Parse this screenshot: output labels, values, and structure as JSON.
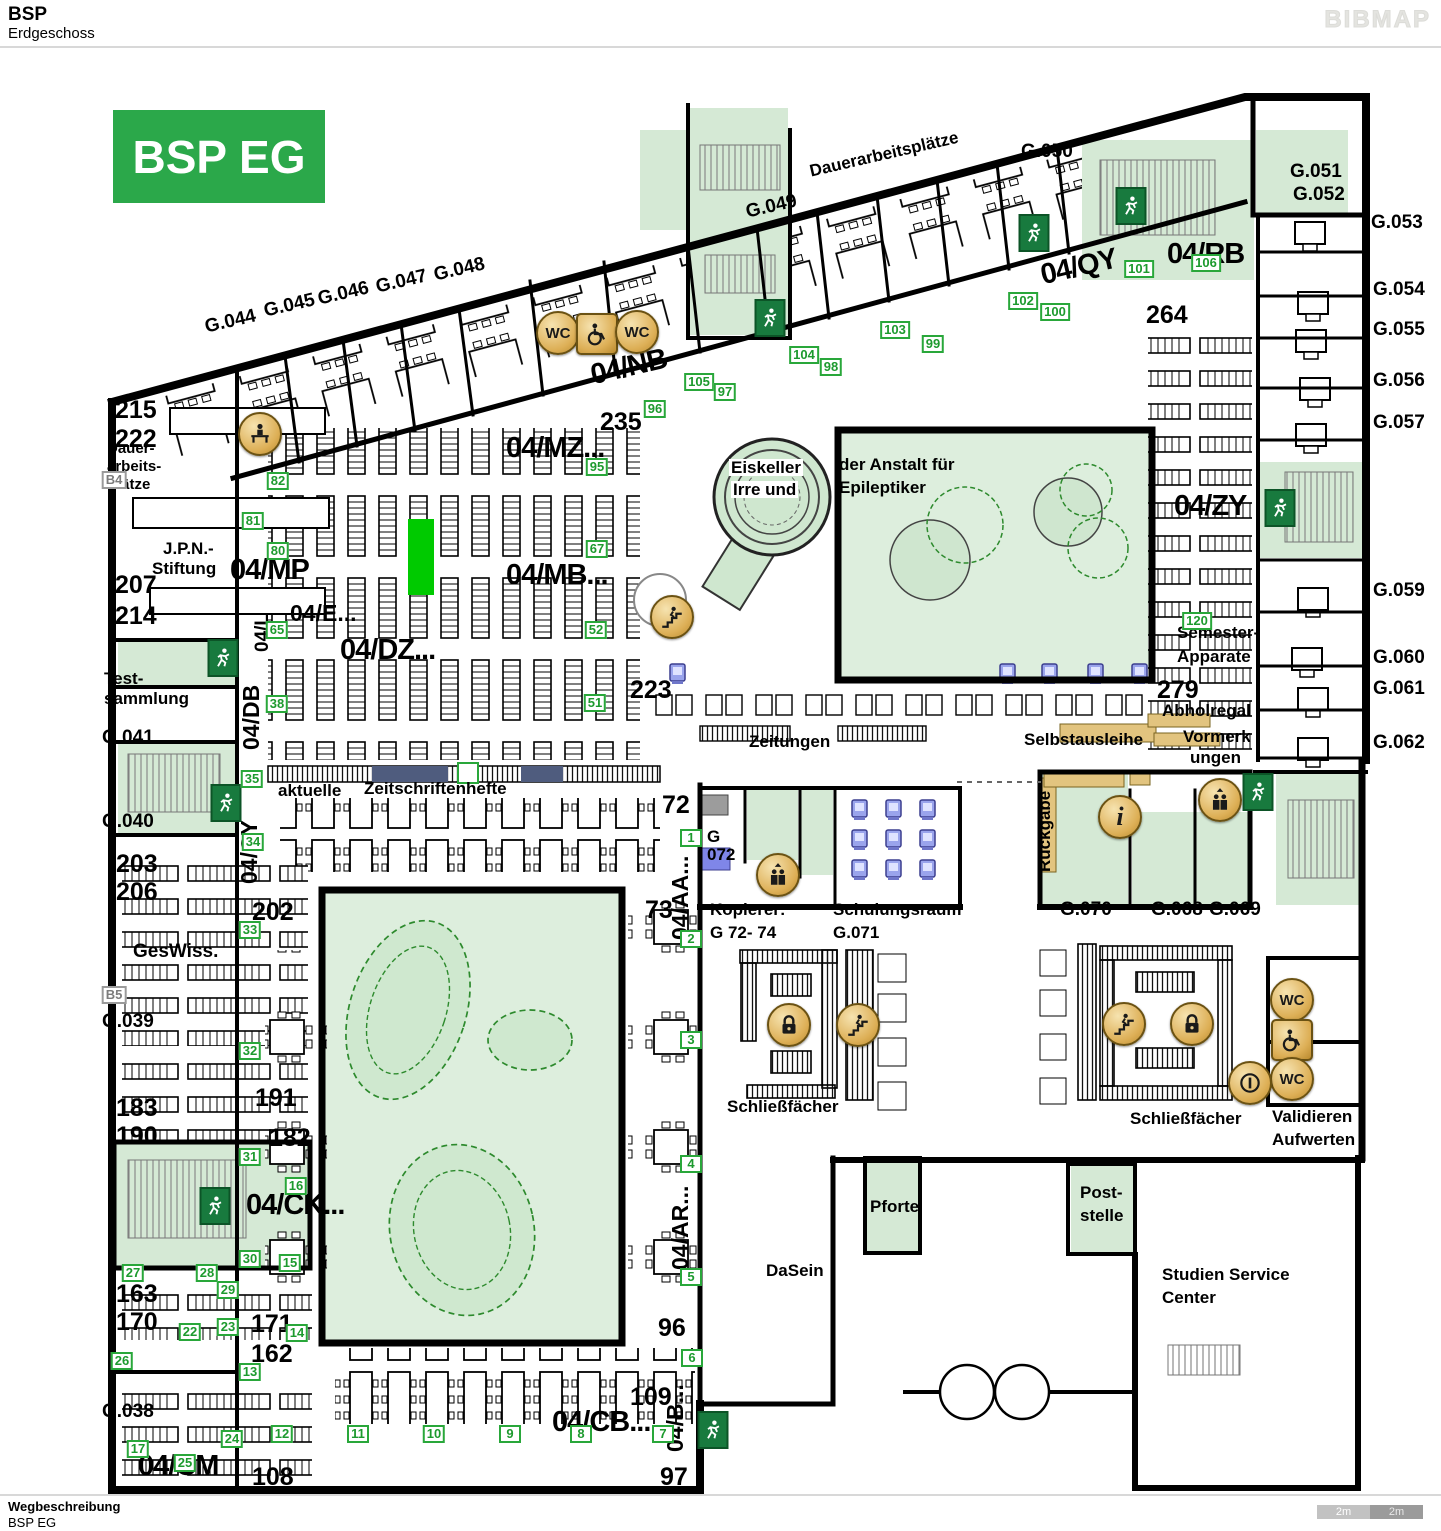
{
  "header": {
    "title": "BSP",
    "subtitle": "Erdgeschoss",
    "logo": "BIBMAP"
  },
  "footer": {
    "label": "Wegbeschreibung",
    "value": "BSP EG",
    "scale": [
      "2m",
      "2m"
    ]
  },
  "plan": {
    "badge": "BSP EG",
    "colors": {
      "badge_green": "#2ba84a",
      "room_green": "#d5e9d5",
      "courtyard_green": "#ddeedd",
      "tree_green": "#2d8a2d",
      "marker_green": "#29a73a",
      "icon_tan": "#ddaf56",
      "exit_green": "#187a3e",
      "khaki": "#e2c47f",
      "navy": "#4f5c7e",
      "computer_blue": "#9aa4ec",
      "highlight_green": "#00ca00",
      "wall_black": "#000000"
    },
    "labels": [
      {
        "t": "G.044",
        "x": 203,
        "y": 318,
        "c": "room",
        "r": -13
      },
      {
        "t": "G.045",
        "x": 262,
        "y": 302,
        "c": "room",
        "r": -13
      },
      {
        "t": "G.046",
        "x": 316,
        "y": 290,
        "c": "room",
        "r": -13
      },
      {
        "t": "G.047",
        "x": 374,
        "y": 278,
        "c": "room",
        "r": -13
      },
      {
        "t": "G.048",
        "x": 432,
        "y": 266,
        "c": "room",
        "r": -13
      },
      {
        "t": "G.049",
        "x": 744,
        "y": 203,
        "c": "room",
        "r": -13
      },
      {
        "t": "Dauerarbeitsplätze",
        "x": 808,
        "y": 163,
        "c": "sm",
        "r": -13
      },
      {
        "t": "G.050",
        "x": 1021,
        "y": 142,
        "c": "room"
      },
      {
        "t": "G.051",
        "x": 1290,
        "y": 162,
        "c": "room"
      },
      {
        "t": "G.052",
        "x": 1293,
        "y": 185,
        "c": "room"
      },
      {
        "t": "G.053",
        "x": 1371,
        "y": 213,
        "c": "room"
      },
      {
        "t": "G.054",
        "x": 1373,
        "y": 280,
        "c": "room"
      },
      {
        "t": "G.055",
        "x": 1373,
        "y": 320,
        "c": "room"
      },
      {
        "t": "G.056",
        "x": 1373,
        "y": 371,
        "c": "room"
      },
      {
        "t": "G.057",
        "x": 1373,
        "y": 413,
        "c": "room"
      },
      {
        "t": "G.059",
        "x": 1373,
        "y": 581,
        "c": "room"
      },
      {
        "t": "G.060",
        "x": 1373,
        "y": 648,
        "c": "room"
      },
      {
        "t": "G.061",
        "x": 1373,
        "y": 679,
        "c": "room"
      },
      {
        "t": "G.062",
        "x": 1373,
        "y": 733,
        "c": "room"
      },
      {
        "t": "04/QY",
        "x": 1038,
        "y": 262,
        "c": "xl",
        "r": -13
      },
      {
        "t": "04/RB",
        "x": 1167,
        "y": 240,
        "c": "xl"
      },
      {
        "t": "264",
        "x": 1146,
        "y": 303,
        "c": "num"
      },
      {
        "t": "04/NB",
        "x": 588,
        "y": 362,
        "c": "xl",
        "r": -13
      },
      {
        "t": "235",
        "x": 600,
        "y": 410,
        "c": "num"
      },
      {
        "t": "04/MZ...",
        "x": 506,
        "y": 434,
        "c": "xl"
      },
      {
        "t": "215",
        "x": 115,
        "y": 398,
        "c": "num"
      },
      {
        "t": "222",
        "x": 115,
        "y": 427,
        "c": "num"
      },
      {
        "t": "Dauer-",
        "x": 107,
        "y": 441,
        "c": "sm2"
      },
      {
        "t": "arbeits-",
        "x": 107,
        "y": 459,
        "c": "sm2"
      },
      {
        "t": "Plätze",
        "x": 107,
        "y": 477,
        "c": "sm2"
      },
      {
        "t": "J.P.N.-",
        "x": 163,
        "y": 540,
        "c": "sm"
      },
      {
        "t": "Stiftung",
        "x": 152,
        "y": 560,
        "c": "sm"
      },
      {
        "t": "207",
        "x": 115,
        "y": 573,
        "c": "num"
      },
      {
        "t": "214",
        "x": 115,
        "y": 604,
        "c": "num"
      },
      {
        "t": "04/MP",
        "x": 230,
        "y": 556,
        "c": "xl"
      },
      {
        "t": "04/MB...",
        "x": 506,
        "y": 561,
        "c": "xl"
      },
      {
        "t": "04/E...",
        "x": 290,
        "y": 602,
        "c": "lg"
      },
      {
        "t": "04/DZ...",
        "x": 340,
        "y": 636,
        "c": "xl"
      },
      {
        "t": "04/L",
        "x": 253,
        "y": 652,
        "c": "room",
        "r": -90
      },
      {
        "t": "04/DB",
        "x": 240,
        "y": 750,
        "c": "lg",
        "r": -90
      },
      {
        "t": "Test-",
        "x": 104,
        "y": 670,
        "c": "sm"
      },
      {
        "t": "sammlung",
        "x": 104,
        "y": 690,
        "c": "sm"
      },
      {
        "t": "G.041",
        "x": 102,
        "y": 728,
        "c": "room"
      },
      {
        "t": "G.040",
        "x": 102,
        "y": 812,
        "c": "room"
      },
      {
        "t": "04/CY",
        "x": 238,
        "y": 884,
        "c": "lg",
        "r": -90
      },
      {
        "t": "203",
        "x": 116,
        "y": 852,
        "c": "num"
      },
      {
        "t": "206",
        "x": 116,
        "y": 880,
        "c": "num"
      },
      {
        "t": "GesWiss.",
        "x": 133,
        "y": 942,
        "c": "room"
      },
      {
        "t": "202",
        "x": 252,
        "y": 900,
        "c": "num"
      },
      {
        "t": "G.039",
        "x": 102,
        "y": 1012,
        "c": "room"
      },
      {
        "t": "aktuelle",
        "x": 278,
        "y": 782,
        "c": "sm"
      },
      {
        "t": "Zeitschriftenhefte",
        "x": 364,
        "y": 780,
        "c": "sm"
      },
      {
        "t": "72",
        "x": 662,
        "y": 793,
        "c": "num"
      },
      {
        "t": "73",
        "x": 645,
        "y": 898,
        "c": "num"
      },
      {
        "t": "G",
        "x": 707,
        "y": 828,
        "c": "sm"
      },
      {
        "t": "072",
        "x": 707,
        "y": 846,
        "c": "sm"
      },
      {
        "t": "Kopierer:",
        "x": 710,
        "y": 901,
        "c": "sm"
      },
      {
        "t": "G 72- 74",
        "x": 710,
        "y": 924,
        "c": "sm"
      },
      {
        "t": "Schulungsraum",
        "x": 833,
        "y": 901,
        "c": "sm"
      },
      {
        "t": "G.071",
        "x": 833,
        "y": 924,
        "c": "sm"
      },
      {
        "t": "Rückgabe",
        "x": 1036,
        "y": 872,
        "c": "sm",
        "r": -90
      },
      {
        "t": "G.070",
        "x": 1060,
        "y": 900,
        "c": "room"
      },
      {
        "t": "G.068",
        "x": 1151,
        "y": 900,
        "c": "room"
      },
      {
        "t": "G.069",
        "x": 1209,
        "y": 900,
        "c": "room"
      },
      {
        "t": "223",
        "x": 630,
        "y": 678,
        "c": "num"
      },
      {
        "t": "Zeitungen",
        "x": 749,
        "y": 733,
        "c": "sm"
      },
      {
        "t": "Selbstausleihe",
        "x": 1024,
        "y": 731,
        "c": "sm"
      },
      {
        "t": "279",
        "x": 1157,
        "y": 678,
        "c": "num"
      },
      {
        "t": "Abholregal",
        "x": 1162,
        "y": 702,
        "c": "sm"
      },
      {
        "t": "Vormerk",
        "x": 1183,
        "y": 728,
        "c": "sm"
      },
      {
        "t": "ungen",
        "x": 1190,
        "y": 749,
        "c": "sm"
      },
      {
        "t": "Semester-",
        "x": 1177,
        "y": 624,
        "c": "sm"
      },
      {
        "t": "Apparate",
        "x": 1177,
        "y": 648,
        "c": "sm"
      },
      {
        "t": "04/ZY",
        "x": 1174,
        "y": 492,
        "c": "xl"
      },
      {
        "t": "Eiskeller",
        "x": 729,
        "y": 459,
        "c": "sm",
        "bg": 1
      },
      {
        "t": "Irre und",
        "x": 731,
        "y": 481,
        "c": "sm",
        "bg": 1
      },
      {
        "t": "der Anstalt für",
        "x": 839,
        "y": 456,
        "c": "sm"
      },
      {
        "t": "Epileptiker",
        "x": 839,
        "y": 479,
        "c": "sm"
      },
      {
        "t": "04/AA...",
        "x": 669,
        "y": 940,
        "c": "lg",
        "r": -90
      },
      {
        "t": "Schließfächer",
        "x": 727,
        "y": 1098,
        "c": "sm"
      },
      {
        "t": "Schließfächer",
        "x": 1130,
        "y": 1110,
        "c": "sm"
      },
      {
        "t": "Validieren",
        "x": 1272,
        "y": 1108,
        "c": "sm"
      },
      {
        "t": "Aufwerten",
        "x": 1272,
        "y": 1131,
        "c": "sm"
      },
      {
        "t": "183",
        "x": 116,
        "y": 1096,
        "c": "num"
      },
      {
        "t": "190",
        "x": 116,
        "y": 1124,
        "c": "num"
      },
      {
        "t": "191",
        "x": 255,
        "y": 1086,
        "c": "num"
      },
      {
        "t": "182",
        "x": 269,
        "y": 1126,
        "c": "num"
      },
      {
        "t": "04/CK...",
        "x": 246,
        "y": 1191,
        "c": "xl"
      },
      {
        "t": "04/AR...",
        "x": 669,
        "y": 1270,
        "c": "lg",
        "r": -90
      },
      {
        "t": "163",
        "x": 116,
        "y": 1282,
        "c": "num"
      },
      {
        "t": "170",
        "x": 116,
        "y": 1310,
        "c": "num"
      },
      {
        "t": "171",
        "x": 251,
        "y": 1312,
        "c": "num"
      },
      {
        "t": "162",
        "x": 251,
        "y": 1342,
        "c": "num"
      },
      {
        "t": "96",
        "x": 658,
        "y": 1316,
        "c": "num"
      },
      {
        "t": "G.038",
        "x": 102,
        "y": 1402,
        "c": "room"
      },
      {
        "t": "109",
        "x": 630,
        "y": 1385,
        "c": "num"
      },
      {
        "t": "04/CB...",
        "x": 552,
        "y": 1408,
        "c": "xl"
      },
      {
        "t": "04/B...",
        "x": 664,
        "y": 1452,
        "c": "lg",
        "r": -90
      },
      {
        "t": "04/CM",
        "x": 138,
        "y": 1452,
        "c": "xl"
      },
      {
        "t": "108",
        "x": 252,
        "y": 1465,
        "c": "num"
      },
      {
        "t": "97",
        "x": 660,
        "y": 1465,
        "c": "num"
      },
      {
        "t": "Pforte",
        "x": 870,
        "y": 1198,
        "c": "sm"
      },
      {
        "t": "Post-",
        "x": 1080,
        "y": 1184,
        "c": "sm"
      },
      {
        "t": "stelle",
        "x": 1080,
        "y": 1207,
        "c": "sm"
      },
      {
        "t": "DaSein",
        "x": 766,
        "y": 1262,
        "c": "sm"
      },
      {
        "t": "Studien Service",
        "x": 1162,
        "y": 1266,
        "c": "sm"
      },
      {
        "t": "Center",
        "x": 1162,
        "y": 1289,
        "c": "sm"
      }
    ],
    "markers": [
      {
        "n": "95",
        "x": 597,
        "y": 467
      },
      {
        "n": "96",
        "x": 655,
        "y": 409
      },
      {
        "n": "105",
        "x": 699,
        "y": 382
      },
      {
        "n": "97",
        "x": 725,
        "y": 392
      },
      {
        "n": "104",
        "x": 804,
        "y": 355
      },
      {
        "n": "98",
        "x": 831,
        "y": 367
      },
      {
        "n": "103",
        "x": 895,
        "y": 330
      },
      {
        "n": "99",
        "x": 933,
        "y": 344
      },
      {
        "n": "102",
        "x": 1023,
        "y": 301
      },
      {
        "n": "100",
        "x": 1055,
        "y": 312
      },
      {
        "n": "101",
        "x": 1139,
        "y": 269
      },
      {
        "n": "106",
        "x": 1206,
        "y": 263
      },
      {
        "n": "82",
        "x": 278,
        "y": 481
      },
      {
        "n": "81",
        "x": 253,
        "y": 521
      },
      {
        "n": "80",
        "x": 278,
        "y": 551
      },
      {
        "n": "65",
        "x": 277,
        "y": 630
      },
      {
        "n": "67",
        "x": 597,
        "y": 549
      },
      {
        "n": "52",
        "x": 596,
        "y": 630
      },
      {
        "n": "51",
        "x": 595,
        "y": 703
      },
      {
        "n": "38",
        "x": 277,
        "y": 704
      },
      {
        "n": "120",
        "x": 1197,
        "y": 621
      },
      {
        "n": "35",
        "x": 252,
        "y": 779
      },
      {
        "n": "34",
        "x": 253,
        "y": 842
      },
      {
        "n": "33",
        "x": 250,
        "y": 930
      },
      {
        "n": "32",
        "x": 250,
        "y": 1051
      },
      {
        "n": "31",
        "x": 250,
        "y": 1157
      },
      {
        "n": "30",
        "x": 250,
        "y": 1259
      },
      {
        "n": "29",
        "x": 228,
        "y": 1290
      },
      {
        "n": "28",
        "x": 207,
        "y": 1273
      },
      {
        "n": "27",
        "x": 133,
        "y": 1273
      },
      {
        "n": "26",
        "x": 122,
        "y": 1361
      },
      {
        "n": "25",
        "x": 185,
        "y": 1463
      },
      {
        "n": "24",
        "x": 232,
        "y": 1439
      },
      {
        "n": "23",
        "x": 228,
        "y": 1327
      },
      {
        "n": "22",
        "x": 190,
        "y": 1332
      },
      {
        "n": "17",
        "x": 138,
        "y": 1449
      },
      {
        "n": "16",
        "x": 296,
        "y": 1186
      },
      {
        "n": "15",
        "x": 290,
        "y": 1263
      },
      {
        "n": "14",
        "x": 297,
        "y": 1333
      },
      {
        "n": "13",
        "x": 250,
        "y": 1372
      },
      {
        "n": "12",
        "x": 282,
        "y": 1434
      },
      {
        "n": "11",
        "x": 358,
        "y": 1434
      },
      {
        "n": "10",
        "x": 434,
        "y": 1434
      },
      {
        "n": "9",
        "x": 510,
        "y": 1434
      },
      {
        "n": "8",
        "x": 581,
        "y": 1434
      },
      {
        "n": "7",
        "x": 663,
        "y": 1434
      },
      {
        "n": "6",
        "x": 692,
        "y": 1358
      },
      {
        "n": "5",
        "x": 691,
        "y": 1277
      },
      {
        "n": "4",
        "x": 691,
        "y": 1164
      },
      {
        "n": "3",
        "x": 691,
        "y": 1040
      },
      {
        "n": "2",
        "x": 691,
        "y": 939
      },
      {
        "n": "1",
        "x": 691,
        "y": 838
      },
      {
        "n": "B4",
        "x": 114,
        "y": 480,
        "g": 1
      },
      {
        "n": "B5",
        "x": 114,
        "y": 995,
        "g": 1
      }
    ],
    "icons": [
      {
        "type": "wc",
        "glyph": "WC",
        "x": 558,
        "y": 333
      },
      {
        "type": "wheelchair",
        "x": 597,
        "y": 334
      },
      {
        "type": "wc",
        "glyph": "WC",
        "x": 637,
        "y": 332
      },
      {
        "type": "desk-person",
        "x": 260,
        "y": 434
      },
      {
        "type": "stairs",
        "x": 672,
        "y": 617
      },
      {
        "type": "elevator",
        "x": 778,
        "y": 875
      },
      {
        "type": "info",
        "glyph": "i",
        "x": 1120,
        "y": 817
      },
      {
        "type": "elevator",
        "x": 1220,
        "y": 800
      },
      {
        "type": "lock",
        "x": 789,
        "y": 1025
      },
      {
        "type": "stairs",
        "x": 858,
        "y": 1025
      },
      {
        "type": "stairs",
        "x": 1124,
        "y": 1024
      },
      {
        "type": "lock",
        "x": 1192,
        "y": 1024
      },
      {
        "type": "wc",
        "glyph": "WC",
        "x": 1292,
        "y": 1000
      },
      {
        "type": "wheelchair",
        "x": 1292,
        "y": 1040
      },
      {
        "type": "wc",
        "glyph": "WC",
        "x": 1292,
        "y": 1079
      },
      {
        "type": "coin",
        "x": 1250,
        "y": 1083
      },
      {
        "type": "exit",
        "x": 770,
        "y": 318
      },
      {
        "type": "exit",
        "x": 1034,
        "y": 233
      },
      {
        "type": "exit",
        "x": 1131,
        "y": 206
      },
      {
        "type": "exit",
        "x": 1280,
        "y": 508
      },
      {
        "type": "exit",
        "x": 223,
        "y": 658
      },
      {
        "type": "exit",
        "x": 226,
        "y": 803
      },
      {
        "type": "exit",
        "x": 215,
        "y": 1206
      },
      {
        "type": "exit",
        "x": 713,
        "y": 1430
      },
      {
        "type": "exit",
        "x": 1258,
        "y": 792
      }
    ]
  }
}
